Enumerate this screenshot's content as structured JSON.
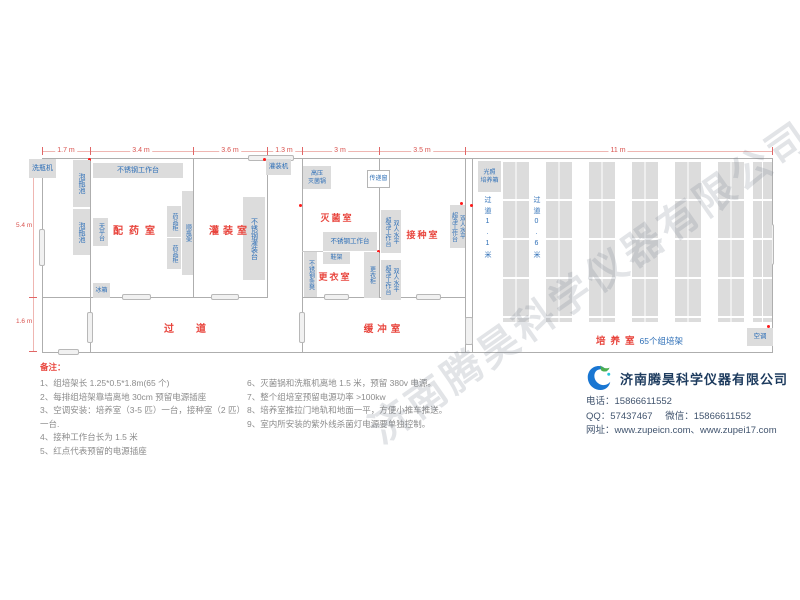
{
  "watermark": "济南腾昊科学仪器有限公司",
  "dims": {
    "top": [
      "1.7 m",
      "3.4 m",
      "3.6 m",
      "1.3 m",
      "3 m",
      "3.5 m",
      "11 m"
    ],
    "left": [
      "5.4 m",
      "1.6 m"
    ]
  },
  "rooms": {
    "peiyao": "配药室",
    "guanzhuang": "灌装室",
    "miejun": "灭菌室",
    "gengyi": "更衣室",
    "jiezhong": "接种室",
    "guodao": "过道",
    "huanchong": "缓冲室",
    "peiyang": "培养室",
    "peiyang_count": "65个组培架"
  },
  "equipment": {
    "washer": "洗瓶机",
    "soak_pool": "泡瓶池",
    "workbench": "不锈钢工作台",
    "balance": "天平台",
    "med_cabinet": "药品柜",
    "bottle_rack": "顺瓶架",
    "fridge": "冰箱",
    "filler": "灌装机",
    "filling_table": "不锈钢灌装台",
    "autoclave_l1": "高压",
    "autoclave_l2": "灭菌锅",
    "pass_window": "传递窗",
    "shoe_rack": "鞋架",
    "locker": "更衣柜",
    "bench": "不锈钢条凳",
    "clean_bench_l1": "双人水平",
    "clean_bench_l2": "超净工作台",
    "incubator_l1": "光照",
    "incubator_l2": "培养箱",
    "ac": "空调",
    "aisle_wide": "过道1.1米",
    "aisle_narrow": "过道0.6米"
  },
  "notes": {
    "title": "备注：",
    "left": [
      "1、组培架长 1.25*0.5*1.8m(65 个)",
      "2、每排组培架靠墙离地 30cm 预留电源插座",
      "3、空调安装：培养室（3-5 匹）一台，接种室（2 匹）一台.",
      "4、接种工作台长为 1.5 米",
      "5、红点代表预留的电源插座"
    ],
    "right": [
      "6、灭菌锅和洗瓶机离地 1.5 米，预留 380v 电源。",
      "7、整个组培室预留电源功率 >100kw",
      "8、培养室推拉门地轨和地面一平，方便小推车推送。",
      "9、室内所安装的紫外线杀菌灯电源要单独控制。"
    ]
  },
  "company": {
    "name": "济南腾昊科学仪器有限公司",
    "phone_label": "电话：",
    "phone": "15866611552",
    "qq_label": "QQ：",
    "qq": "57437467",
    "wechat_label": "微信：",
    "wechat": "15866611552",
    "web_label": "网址：",
    "web": "www.zupeicn.com、www.zupei17.com"
  }
}
